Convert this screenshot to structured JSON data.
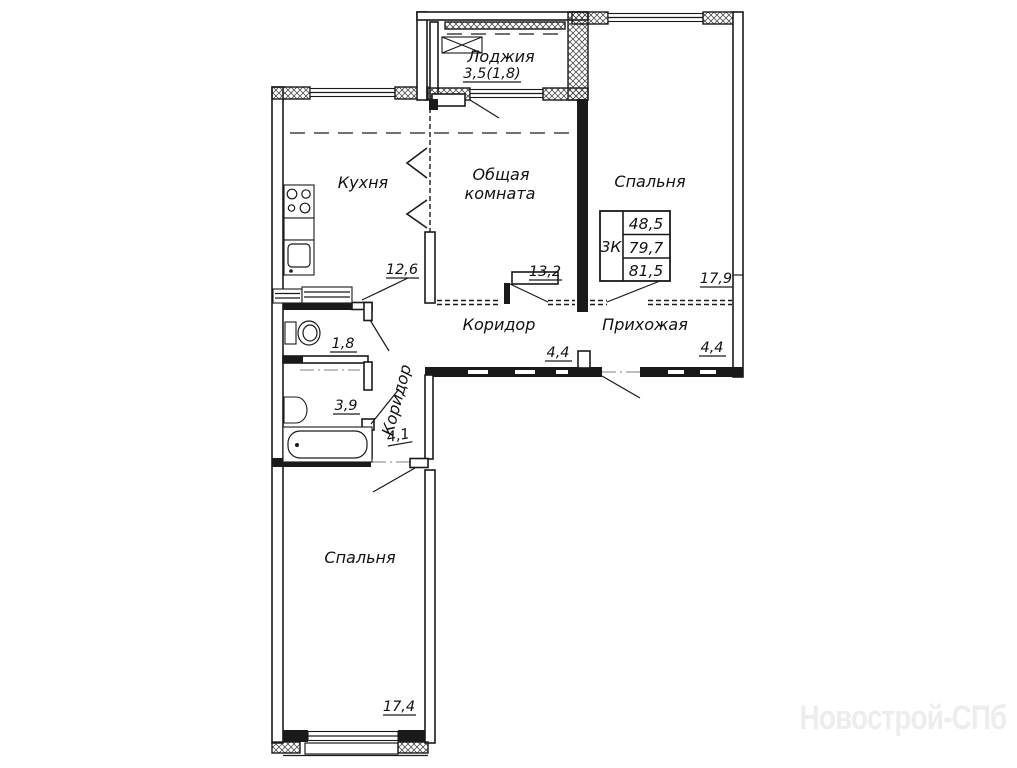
{
  "plan": {
    "type": "apartment-floor-plan",
    "watermark": "Новострой-СПб",
    "rooms": {
      "loggia": {
        "label": "Лоджия",
        "area": "3,5(1,8)"
      },
      "kitchen": {
        "label": "Кухня",
        "area": "12,6"
      },
      "living": {
        "line1": "Общая",
        "line2": "комната",
        "area": "13,2"
      },
      "bedroom_right": {
        "label": "Спальня",
        "area": "17,9"
      },
      "corridor": {
        "label": "Коридор",
        "area": "4,4"
      },
      "hallway": {
        "label": "Прихожая",
        "area": "4,4"
      },
      "wc": {
        "area": "1,8"
      },
      "bathroom": {
        "area": "3,9"
      },
      "corridor_small": {
        "label": "Коридор",
        "area": "4,1"
      },
      "bedroom_bottom": {
        "label": "Спальня",
        "area": "17,4"
      }
    },
    "info_table": {
      "type_label": "3К",
      "living_area": "48,5",
      "floor_area": "79,7",
      "total_area": "81,5"
    }
  },
  "colors": {
    "line": "#1a1a1a",
    "watermark": "#ededed",
    "background": "#ffffff"
  }
}
